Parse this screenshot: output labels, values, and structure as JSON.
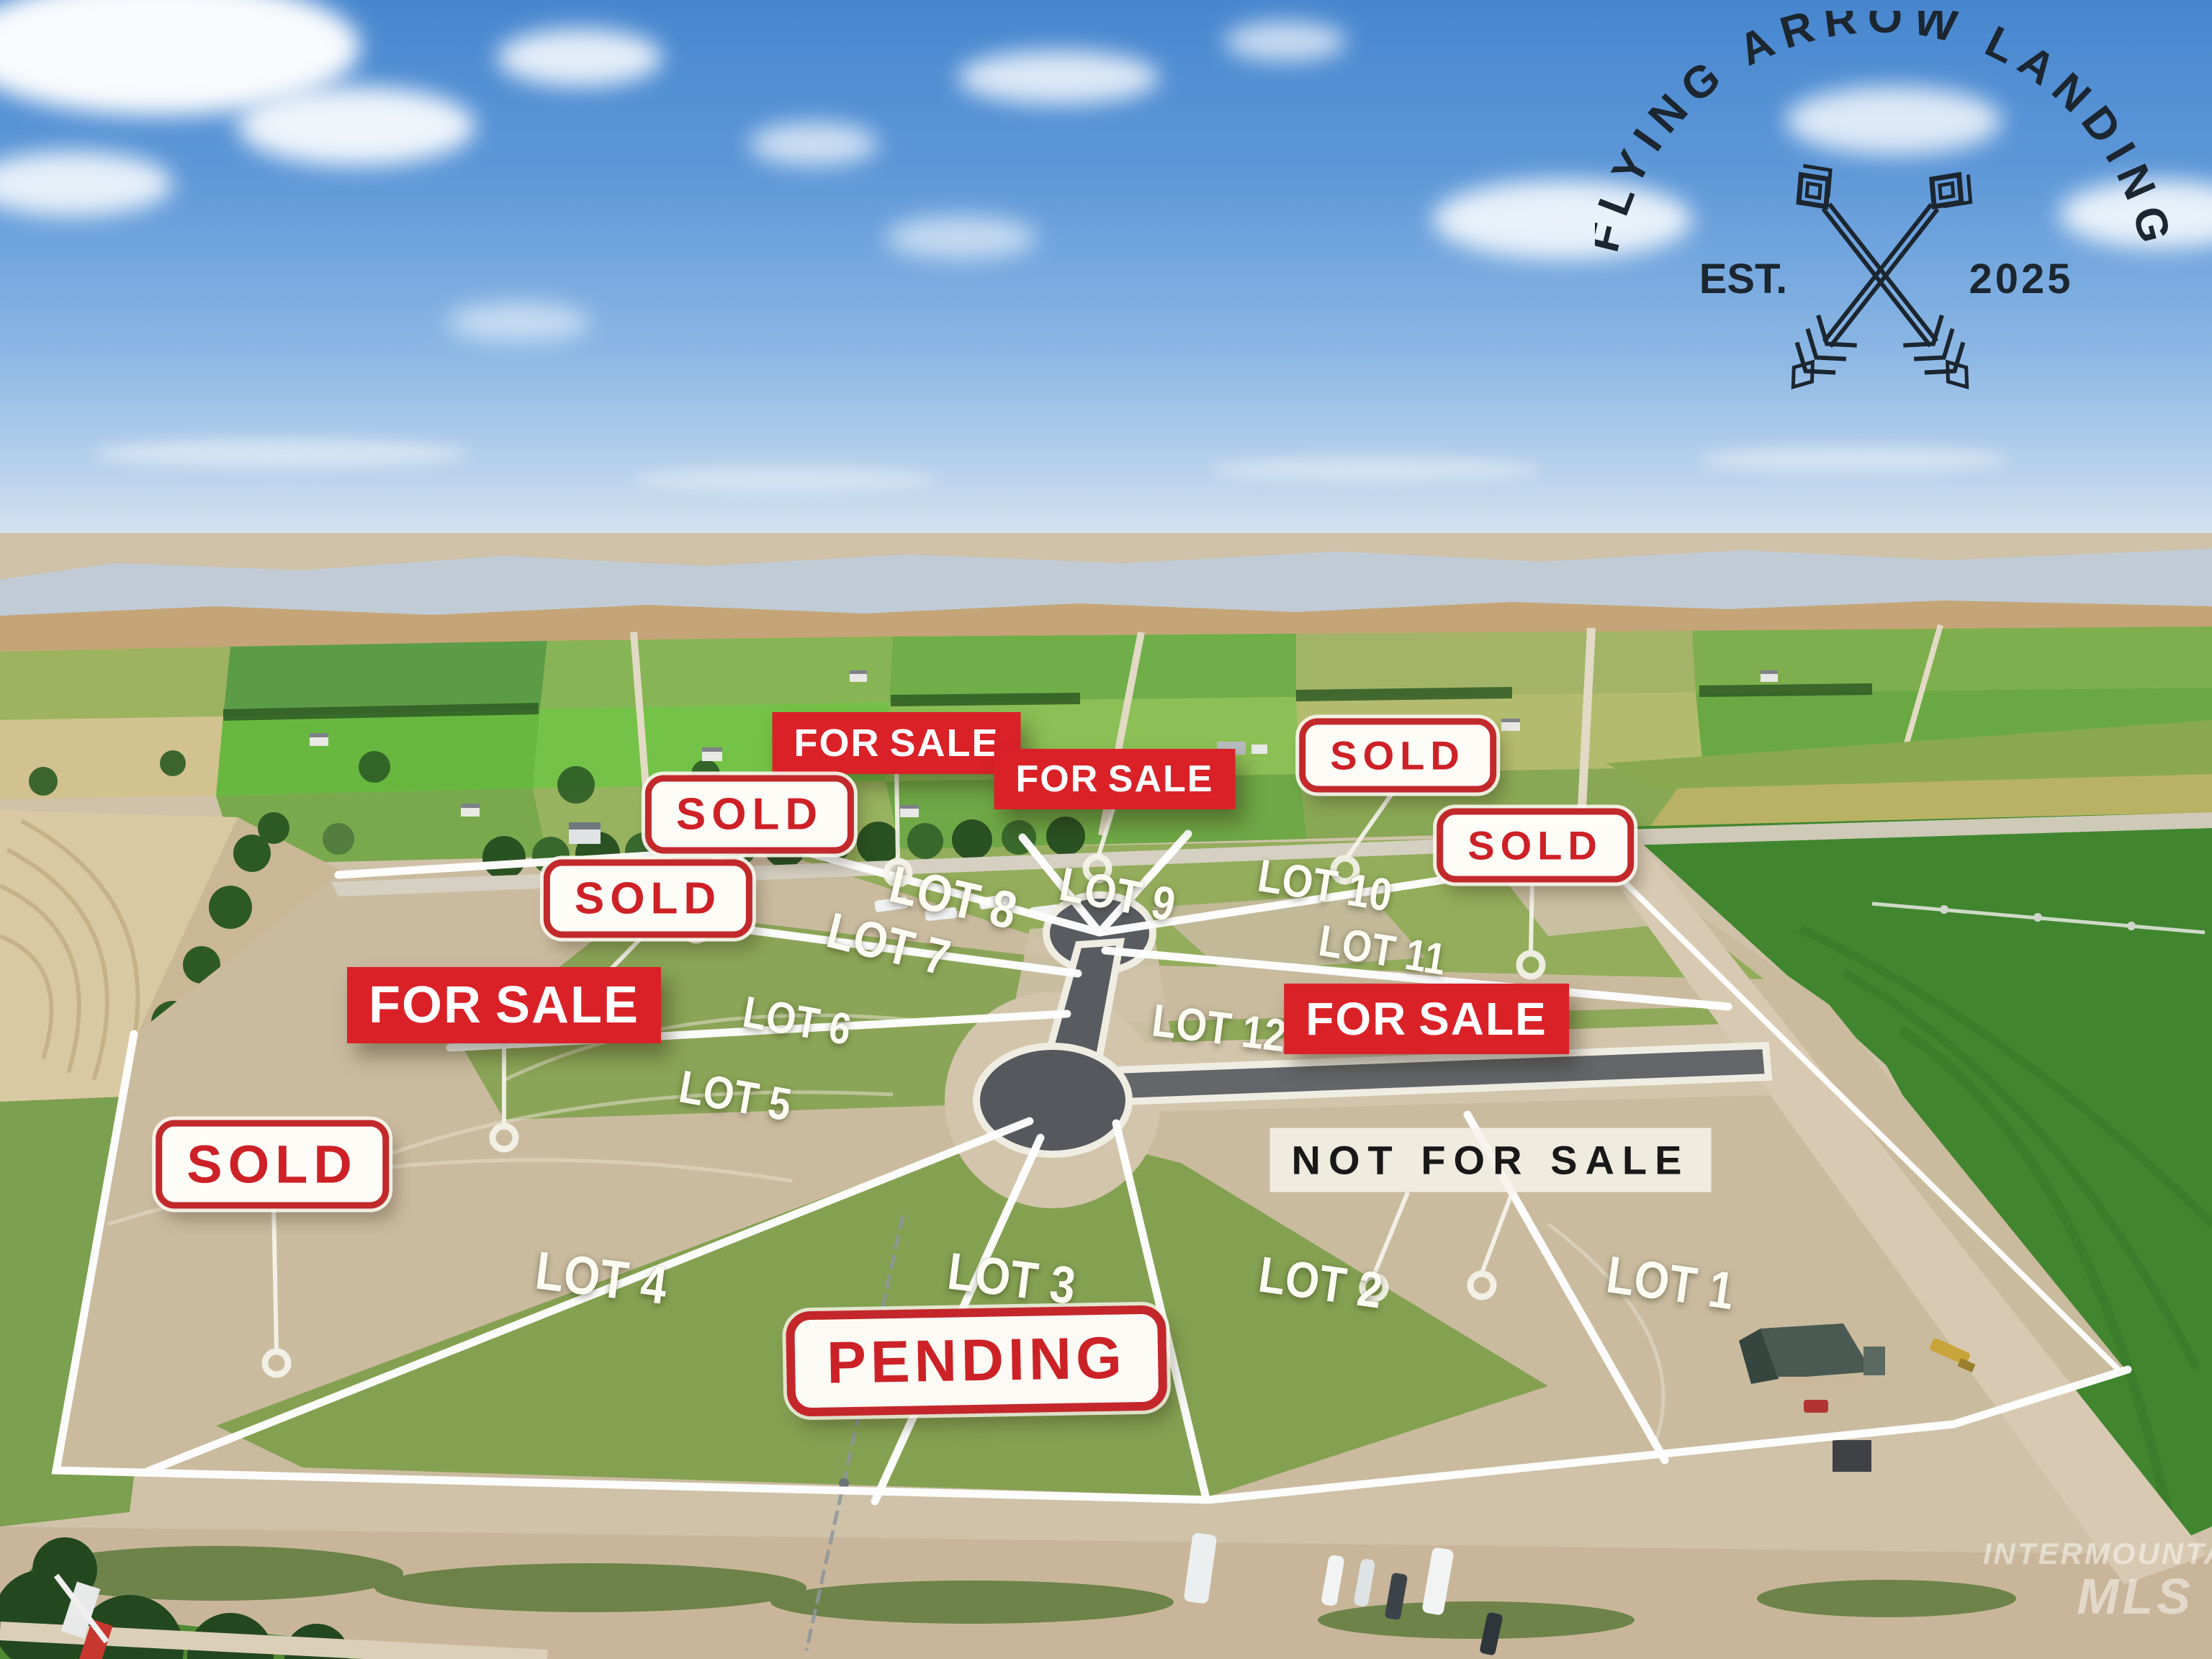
{
  "logo": {
    "arc_text": "FLYING ARROW LANDING",
    "est_label": "EST.",
    "year": "2025"
  },
  "badges": [
    {
      "name": "for-sale-lot8",
      "label": "FOR SALE",
      "type": "for-sale"
    },
    {
      "name": "for-sale-lot9",
      "label": "FOR SALE",
      "type": "for-sale"
    },
    {
      "name": "sold-lot10",
      "label": "SOLD",
      "type": "sold"
    },
    {
      "name": "sold-lot11",
      "label": "SOLD",
      "type": "sold"
    },
    {
      "name": "sold-lot7",
      "label": "SOLD",
      "type": "sold"
    },
    {
      "name": "sold-lot6",
      "label": "SOLD",
      "type": "sold"
    },
    {
      "name": "for-sale-lot5",
      "label": "FOR SALE",
      "type": "for-sale"
    },
    {
      "name": "for-sale-lot12",
      "label": "FOR SALE",
      "type": "for-sale"
    },
    {
      "name": "sold-lot4",
      "label": "SOLD",
      "type": "sold"
    },
    {
      "name": "not-for-sale",
      "label": "NOT FOR SALE",
      "type": "not-for-sale"
    },
    {
      "name": "pending",
      "label": "PENDING",
      "type": "pending"
    }
  ],
  "lots": [
    {
      "label": "LOT 1"
    },
    {
      "label": "LOT 2"
    },
    {
      "label": "LOT 3"
    },
    {
      "label": "LOT 4"
    },
    {
      "label": "LOT 5"
    },
    {
      "label": "LOT 6"
    },
    {
      "label": "LOT 7"
    },
    {
      "label": "LOT 8"
    },
    {
      "label": "LOT 9"
    },
    {
      "label": "LOT 10"
    },
    {
      "label": "LOT 11"
    },
    {
      "label": "LOT 12"
    }
  ],
  "watermark": {
    "line1": "INTERMOUNTAIN",
    "line2": "MLS"
  },
  "colors": {
    "badge_red": "#da2128",
    "sold_red": "#cd2127",
    "sold_border": "#c2292b",
    "not_for_sale_text": "#181818",
    "lot_line_white": "#ffffff",
    "logo_ink": "#1b2630"
  }
}
